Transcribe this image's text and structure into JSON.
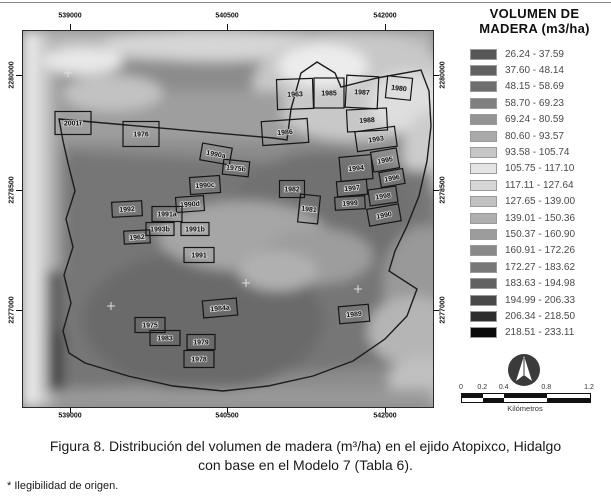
{
  "figure": {
    "caption_line1": "Figura 8. Distribución del volumen de madera (m³/ha) en el ejido Atopixco, Hidalgo",
    "caption_line2": "con base en el Modelo 7 (Tabla 6).",
    "footnote": "* Ilegibilidad de origen."
  },
  "legend": {
    "title_line1": "VOLUMEN DE",
    "title_line2": "MADERA (m3/ha)",
    "classes": [
      {
        "range": "26.24 - 37.59",
        "color": "#575757"
      },
      {
        "range": "37.60 - 48.14",
        "color": "#616161"
      },
      {
        "range": "48.15 - 58.69",
        "color": "#6e6e6e"
      },
      {
        "range": "58.70 - 69.23",
        "color": "#808080"
      },
      {
        "range": "69.24 - 80.59",
        "color": "#949494"
      },
      {
        "range": "80.60 - 93.57",
        "color": "#aaaaaa"
      },
      {
        "range": "93.58 - 105.74",
        "color": "#c7c7c7"
      },
      {
        "range": "105.75 - 117.10",
        "color": "#e4e4e4"
      },
      {
        "range": "117.11 - 127.64",
        "color": "#d6d6d6"
      },
      {
        "range": "127.65 - 139.00",
        "color": "#c1c1c1"
      },
      {
        "range": "139.01 - 150.36",
        "color": "#afafaf"
      },
      {
        "range": "150.37 - 160.90",
        "color": "#9c9c9c"
      },
      {
        "range": "160.91 - 172.26",
        "color": "#8a8a8a"
      },
      {
        "range": "172.27 - 183.62",
        "color": "#787878"
      },
      {
        "range": "183.63 - 194.98",
        "color": "#626262"
      },
      {
        "range": "194.99 - 206.33",
        "color": "#494949"
      },
      {
        "range": "206.34 - 218.50",
        "color": "#2e2e2e"
      },
      {
        "range": "218.51 - 233.11",
        "color": "#0a0a0a"
      }
    ]
  },
  "map": {
    "x_axis_labels": [
      "539000",
      "540500",
      "542000"
    ],
    "y_axis_labels": [
      "2280000",
      "2278500",
      "2277000"
    ],
    "stands": [
      {
        "label": "1963",
        "x": 272,
        "y": 63,
        "w": 36,
        "h": 30,
        "rot": -2
      },
      {
        "label": "1985",
        "x": 306,
        "y": 62,
        "w": 30,
        "h": 30,
        "rot": 0
      },
      {
        "label": "1987",
        "x": 339,
        "y": 61,
        "w": 32,
        "h": 32,
        "rot": 3
      },
      {
        "label": "1980",
        "x": 376,
        "y": 57,
        "w": 25,
        "h": 22,
        "rot": 6
      },
      {
        "label": "1988",
        "x": 344,
        "y": 89,
        "w": 40,
        "h": 22,
        "rot": -3
      },
      {
        "label": "1986",
        "x": 262,
        "y": 101,
        "w": 46,
        "h": 24,
        "rot": -4
      },
      {
        "label": "1993",
        "x": 353,
        "y": 108,
        "w": 40,
        "h": 20,
        "rot": -8
      },
      {
        "label": "1994",
        "x": 333,
        "y": 137,
        "w": 32,
        "h": 24,
        "rot": -5
      },
      {
        "label": "1995",
        "x": 362,
        "y": 129,
        "w": 26,
        "h": 20,
        "rot": -10
      },
      {
        "label": "1996",
        "x": 369,
        "y": 147,
        "w": 24,
        "h": 15,
        "rot": -10
      },
      {
        "label": "1997",
        "x": 329,
        "y": 157,
        "w": 30,
        "h": 15,
        "rot": -5
      },
      {
        "label": "1998",
        "x": 360,
        "y": 165,
        "w": 28,
        "h": 16,
        "rot": -8
      },
      {
        "label": "1999",
        "x": 327,
        "y": 172,
        "w": 30,
        "h": 13,
        "rot": -3
      },
      {
        "label": "1990",
        "x": 361,
        "y": 184,
        "w": 32,
        "h": 17,
        "rot": -10
      },
      {
        "label": "1982",
        "x": 269,
        "y": 158,
        "w": 25,
        "h": 17,
        "rot": 0
      },
      {
        "label": "1981",
        "x": 286,
        "y": 178,
        "w": 20,
        "h": 28,
        "rot": 6
      },
      {
        "label": "2001r",
        "x": 50,
        "y": 92,
        "w": 36,
        "h": 23,
        "rot": 0
      },
      {
        "label": "1976",
        "x": 118,
        "y": 103,
        "w": 36,
        "h": 25,
        "rot": 0
      },
      {
        "label": "1990a",
        "x": 193,
        "y": 123,
        "w": 30,
        "h": 17,
        "rot": 10
      },
      {
        "label": "1975b",
        "x": 213,
        "y": 137,
        "w": 26,
        "h": 15,
        "rot": 6
      },
      {
        "label": "1990c",
        "x": 182,
        "y": 154,
        "w": 30,
        "h": 17,
        "rot": -4
      },
      {
        "label": "1990d",
        "x": 167,
        "y": 173,
        "w": 28,
        "h": 15,
        "rot": -4
      },
      {
        "label": "1992",
        "x": 104,
        "y": 178,
        "w": 30,
        "h": 15,
        "rot": -3
      },
      {
        "label": "1991a",
        "x": 144,
        "y": 183,
        "w": 30,
        "h": 15,
        "rot": 0
      },
      {
        "label": "1993b",
        "x": 137,
        "y": 198,
        "w": 28,
        "h": 13,
        "rot": 0
      },
      {
        "label": "1962",
        "x": 114,
        "y": 206,
        "w": 26,
        "h": 13,
        "rot": -3
      },
      {
        "label": "1991b",
        "x": 172,
        "y": 198,
        "w": 28,
        "h": 13,
        "rot": 0
      },
      {
        "label": "1991",
        "x": 176,
        "y": 224,
        "w": 30,
        "h": 15,
        "rot": 0
      },
      {
        "label": "1984a",
        "x": 197,
        "y": 277,
        "w": 34,
        "h": 17,
        "rot": -5
      },
      {
        "label": "1975",
        "x": 127,
        "y": 294,
        "w": 30,
        "h": 15,
        "rot": 0
      },
      {
        "label": "1983",
        "x": 142,
        "y": 307,
        "w": 30,
        "h": 15,
        "rot": 0
      },
      {
        "label": "1979",
        "x": 178,
        "y": 311,
        "w": 28,
        "h": 15,
        "rot": 0
      },
      {
        "label": "1978",
        "x": 176,
        "y": 328,
        "w": 30,
        "h": 17,
        "rot": 0
      },
      {
        "label": "1989",
        "x": 331,
        "y": 283,
        "w": 30,
        "h": 17,
        "rot": -5
      }
    ]
  },
  "scalebar": {
    "ticks": [
      "0",
      "0.2",
      "0.4",
      "0.8",
      "1.2"
    ],
    "unit": "Kilómetros"
  }
}
